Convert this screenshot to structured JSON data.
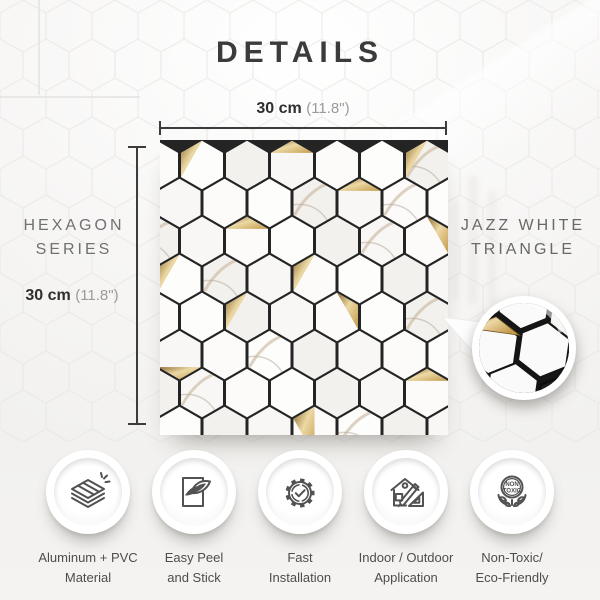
{
  "page": {
    "title": "DETAILS"
  },
  "dimension_top": {
    "value": "30 cm",
    "alt": "(11.8\")"
  },
  "dimension_left": {
    "value": "30 cm",
    "alt": "(11.8\")"
  },
  "series_label": {
    "line1": "HEXAGON",
    "line2": "SERIES"
  },
  "product_label": {
    "line1": "JAZZ WHITE",
    "line2": "TRIANGLE"
  },
  "features": [
    {
      "icon": "material-layers-icon",
      "line1": "Aluminum + PVC",
      "line2": "Material"
    },
    {
      "icon": "peel-stick-icon",
      "line1": "Easy Peel",
      "line2": "and Stick"
    },
    {
      "icon": "gear-check-icon",
      "line1": "Fast",
      "line2": "Installation"
    },
    {
      "icon": "house-tools-icon",
      "line1": "Indoor / Outdoor",
      "line2": "Application"
    },
    {
      "icon": "non-toxic-badge-icon",
      "line1": "Non-Toxic/",
      "line2": "Eco-Friendly"
    }
  ],
  "non_toxic_badge": {
    "line1": "NON",
    "line2": "TOXIC"
  },
  "colors": {
    "gold": "#c49a4d",
    "gold_light": "#ecd9a4",
    "gold_dark": "#8f6b2f",
    "grout": "#242424",
    "hex_white": "#fcfbfa",
    "hex_shade": "#f3f1ee",
    "vein": "#c3ae92",
    "vein2": "#b3a898",
    "text_dark": "#3b3b3b",
    "text_gray": "#717171",
    "dim_line": "#3c3c3c"
  },
  "tile": {
    "rows": 8,
    "cols": 7,
    "hex_radius": 25.4,
    "col_spacing": 45,
    "row_spacing": 38,
    "even_start": -3,
    "odd_start": 19.5,
    "width": 288,
    "height": 295,
    "gold": [
      [
        0,
        1,
        [
          0,
          1,
          2
        ]
      ],
      [
        0,
        3,
        [
          1,
          0,
          5
        ]
      ],
      [
        0,
        6,
        [
          0,
          1,
          2
        ]
      ],
      [
        1,
        4,
        [
          1,
          0,
          5
        ]
      ],
      [
        2,
        6,
        [
          0,
          5,
          4
        ]
      ],
      [
        2,
        2,
        [
          1,
          0,
          5
        ]
      ],
      [
        3,
        0,
        [
          0,
          1,
          2
        ]
      ],
      [
        3,
        3,
        [
          0,
          1,
          2
        ]
      ],
      [
        4,
        2,
        [
          0,
          1,
          2
        ]
      ],
      [
        4,
        4,
        [
          0,
          5,
          4
        ]
      ],
      [
        5,
        0,
        [
          2,
          3,
          4
        ]
      ],
      [
        6,
        6,
        [
          1,
          0,
          5
        ]
      ],
      [
        7,
        3,
        [
          1,
          0,
          3
        ]
      ]
    ],
    "marble": [
      [
        0,
        6
      ],
      [
        1,
        3
      ],
      [
        2,
        0
      ],
      [
        2,
        5
      ],
      [
        3,
        1
      ],
      [
        4,
        6
      ],
      [
        5,
        2
      ],
      [
        6,
        1
      ],
      [
        7,
        4
      ],
      [
        1,
        5
      ]
    ]
  },
  "inset": {
    "hex_radius": 30,
    "rotation": 8,
    "white_hexes": [
      [
        30,
        22
      ],
      [
        82,
        18
      ],
      [
        134,
        22
      ],
      [
        56,
        67
      ],
      [
        108,
        63
      ],
      [
        30,
        112
      ],
      [
        82,
        108
      ]
    ],
    "black_hexes": [
      [
        134,
        112
      ],
      [
        158,
        66
      ]
    ],
    "gold_triangle": [
      [
        56,
        37
      ],
      [
        30,
        52
      ],
      [
        82,
        52
      ]
    ]
  }
}
